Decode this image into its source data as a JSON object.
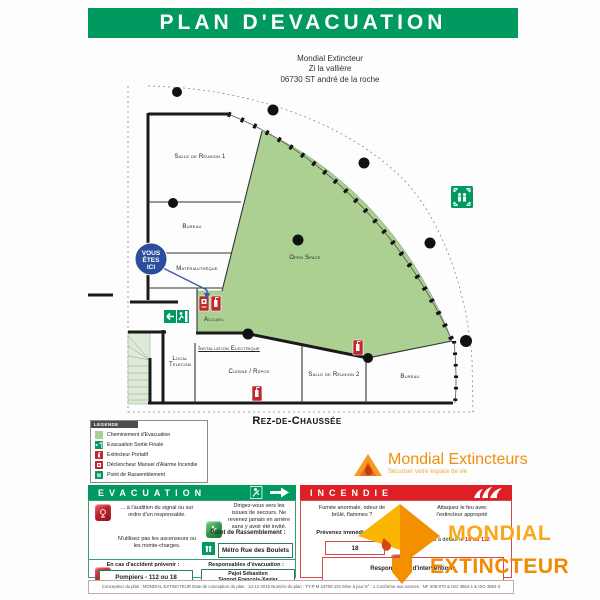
{
  "header": {
    "title": "PLAN D'EVACUATION"
  },
  "address": {
    "lines": [
      "Mondial Extincteur",
      "Zi la vallière",
      "06730 ST andré de la roche"
    ]
  },
  "plan": {
    "floor_label": "Rez-de-Chaussée",
    "you_are_here": [
      "VOUS",
      "ÊTES",
      "ICI"
    ],
    "rooms": [
      {
        "label": "Salle de Réunion 1"
      },
      {
        "label": "Bureau"
      },
      {
        "label": "Matériauthèque"
      },
      {
        "label": "Open Space"
      },
      {
        "label": "Accueil"
      },
      {
        "label": "Local\nTelecom"
      },
      {
        "label": "Installation Electrique"
      },
      {
        "label": "Cuisine / Repos"
      },
      {
        "label": "Salle de Réunion 2"
      },
      {
        "label": "Bureau"
      }
    ]
  },
  "legend": {
    "title": "LEGENDE",
    "items": [
      {
        "icon": "evacuation-path-swatch",
        "label": "Cheminement d'Evacuation"
      },
      {
        "icon": "final-exit-icon",
        "label": "Evacuation Sortie Finale"
      },
      {
        "icon": "extinguisher-icon",
        "label": "Extincteur Portatif"
      },
      {
        "icon": "manual-alarm-icon",
        "label": "Déclencheur Manuel d'Alarme Incendie"
      },
      {
        "icon": "assembly-point-icon",
        "label": "Point de Rassemblement"
      }
    ]
  },
  "brand": {
    "name": "Mondial Extincteurs",
    "tagline": "Sécuriser votre espace de vie"
  },
  "evacuation": {
    "title": "EVACUATION",
    "signal": "... à l'audition du signal ou sur ordre d'un responsable.",
    "direct": "Dirigez-vous vers les issues de secours. Ne revenez jamais en arrière sans y avoir été invité.",
    "no_elevator": "N'utilisez pas les ascenseurs ou les monte-charges.",
    "assembly_label": "Point de Rassemblement :",
    "assembly_value": "Métro Rue des Boulets",
    "accident_label": "En cas d'accident prévenir :",
    "accident_value": "Pompiers - 112 ou 18",
    "responsible_label": "Responsables d'évacuation :",
    "responsible_value": "Pajot Sébastien\nSignori François-Xavier"
  },
  "incendie": {
    "title": "INCENDIE",
    "smoke": "Fumée anormale, odeur de brûlé, flammes ?",
    "notify_label": "Prévenez immédiatement",
    "notify_value": "18",
    "attack": "Attaquez le feu avec l'extincteur approprié",
    "fallback_label": "ou à défaut le",
    "fallback_value": "18 ou 112",
    "responders_label": "Responsables d'intervention :",
    "responders_value": ""
  },
  "footer": {
    "text": "Concepteur du plan : MONDIAL EXTINCTEUR     Date de conception du plan : 13-12-2016     Numéro du plan : TY-P M 23700-101     Mise à jour N° : 1     Conforme aux normes : NF X08-070 & ISO 3864-1 & ISO 3864-3"
  },
  "watermark": {
    "line1": "MONDIAL",
    "line2": "EXTINCTEUR"
  },
  "colors": {
    "accent_green": "#009a60",
    "accent_red": "#dd2026",
    "plan_green": "#abd092",
    "badge_blue": "#2b4e9e",
    "brand_orange": "#f9a81b"
  }
}
